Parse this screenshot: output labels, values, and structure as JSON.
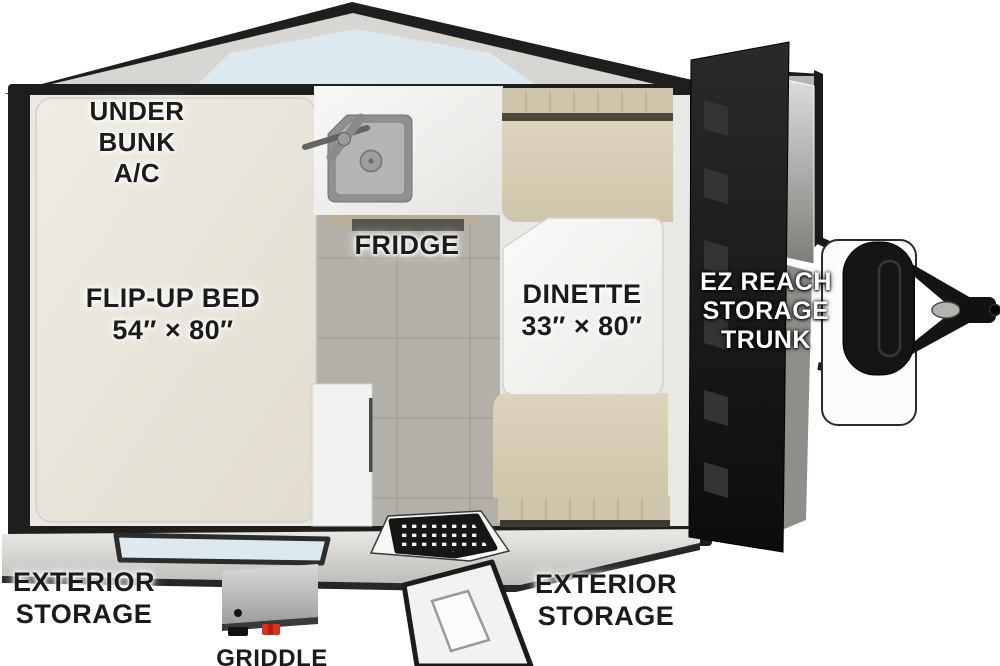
{
  "title": "Teardrop travel trailer floor plan",
  "colors": {
    "wall": "#1e1e1c",
    "roof": "#d7d6d3",
    "glass": "#dde9f1",
    "mattress": "#ebe7dd",
    "cushion": "#d9cfb6",
    "cushion_band": "#cfc5ab",
    "floor_tile": "#b3b0aa",
    "counter": "#f3f3f1",
    "trunk_lid": "#161615",
    "accent_red": "#df2e1b"
  },
  "labels": {
    "under_bunk": [
      "UNDER",
      "BUNK",
      "A/C"
    ],
    "flip_up_bed": [
      "FLIP-UP BED",
      "54″ × 80″"
    ],
    "fridge": "FRIDGE",
    "dinette": [
      "DINETTE",
      "33″ × 80″"
    ],
    "ez_reach": [
      "EZ REACH",
      "STORAGE",
      "TRUNK"
    ],
    "exterior_storage_left": [
      "EXTERIOR",
      "STORAGE"
    ],
    "exterior_storage_right": [
      "EXTERIOR",
      "STORAGE"
    ],
    "griddle": "GRIDDLE"
  }
}
